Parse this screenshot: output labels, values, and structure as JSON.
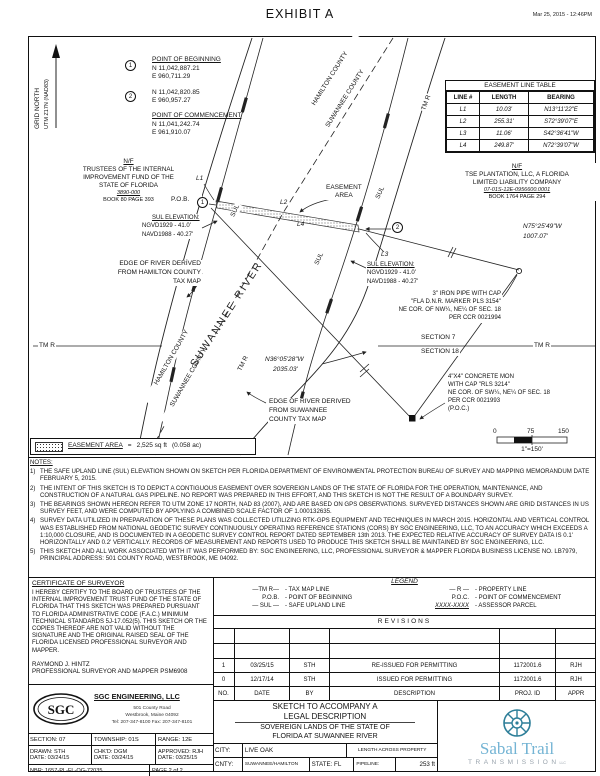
{
  "header": {
    "title": "EXHIBIT A",
    "timestamp": "Mar 25, 2015 - 12:46PM"
  },
  "north": {
    "line1": "GRID NORTH",
    "line2": "UTM Z17N (NAD83)"
  },
  "points": {
    "pob_num": "1",
    "pob_title": "POINT OF BEGINNING",
    "pob_n": "N 11,042,887.21",
    "pob_e": "E 960,711.29",
    "p2_num": "2",
    "p2_n": "N 11,042,820.85",
    "p2_e": "E 960,957.27",
    "poc_title": "POINT OF COMMENCEMENT",
    "poc_n": "N 11,041,242.74",
    "poc_e": "E 961,910.07"
  },
  "easement_table": {
    "title": "EASEMENT LINE TABLE",
    "headers": [
      "LINE #",
      "LENGTH",
      "BEARING"
    ],
    "rows": [
      [
        "L1",
        "10.03'",
        "N13°11'22\"E"
      ],
      [
        "L2",
        "255.31'",
        "S72°39'07\"E"
      ],
      [
        "L3",
        "11.06'",
        "S42°36'41\"W"
      ],
      [
        "L4",
        "249.87'",
        "N72°39'07\"W"
      ]
    ]
  },
  "owners": {
    "west": {
      "nf": "N/F",
      "name1": "TRUSTEES OF THE INTERNAL",
      "name2": "IMPROVEMENT FUND OF THE",
      "name3": "STATE OF FLORIDA",
      "parcel": "3890-000",
      "book": "BOOK 80 PAGE 393"
    },
    "east": {
      "nf": "N/F",
      "name1": "TSE PLANTATION, LLC, A FLORIDA",
      "name2": "LIMITED LIABILITY COMPANY",
      "parcel": "07-01S-12E-0956600.0001",
      "book": "BOOK 1764 PAGE 294"
    }
  },
  "map_labels": {
    "pob": "P.O.B.",
    "easement_area": "EASEMENT\nAREA",
    "l1": "L1",
    "l2": "L2",
    "l3": "L3",
    "l4": "L4",
    "sul": "SUL",
    "tm_r": "TM R",
    "hamilton": "HAMILTON COUNTY",
    "suwannee": "SUWANNEE COUNTY",
    "river": "SUWANNEE RIVER",
    "sul_elev_title": "SUL ELEVATION:",
    "sul_elev_ngvd": "NGVD1929 - 41.0'",
    "sul_elev_navd": "NAVD1988 - 40.27'",
    "bearing75_1": "N75°25'49\"W",
    "bearing75_2": "1007.07'",
    "bearing36_1": "N36°05'28\"W",
    "bearing36_2": "2035.03'",
    "iron1": "3\" IRON PIPE WITH CAP",
    "iron2": "\"FLA D.N.R. MARKER PLS 3154\"",
    "iron3": "NE COR. OF NW¼, NE¼ OF SEC. 18",
    "iron4": "PER CCR 0021994",
    "section7": "SECTION 7",
    "section18": "SECTION 18",
    "mon1": "4\"X4\" CONCRETE MON",
    "mon2": "WITH CAP \"RLS 3214\"",
    "mon3": "NE COR. OF SW¼, NE¼ OF SEC. 18",
    "mon4": "PER CCR 0021993",
    "mon5": "(P.O.C.)",
    "edge_hamilton1": "EDGE OF RIVER DERIVED",
    "edge_hamilton2": "FROM HAMILTON COUNTY",
    "edge_hamilton3": "TAX MAP",
    "edge_suwannee1": "EDGE OF RIVER DERIVED",
    "edge_suwannee2": "FROM SUWANNEE",
    "edge_suwannee3": "COUNTY TAX MAP"
  },
  "scale": {
    "t0": "0",
    "t75": "75",
    "t150": "150",
    "ratio": "1\"=150'"
  },
  "area_legend": {
    "label": "EASEMENT AREA",
    "eq": "=",
    "value": "2,525 sq ft",
    "ac": "(0.058 ac)"
  },
  "notes": {
    "title": "NOTES:",
    "items": [
      {
        "n": "1)",
        "t": "THE SAFE UPLAND LINE (SUL) ELEVATION SHOWN ON SKETCH PER FLORIDA DEPARTMENT OF ENVIRONMENTAL PROTECTION BUREAU OF SURVEY AND MAPPING MEMORANDUM DATE FEBRUARY 5, 2015."
      },
      {
        "n": "2)",
        "t": "THE INTENT OF THIS SKETCH IS TO DEPICT A CONTIGUOUS EASEMENT OVER SOVEREIGN LANDS OF THE STATE OF FLORIDA FOR THE OPERATION, MAINTENANCE, AND CONSTRUCTION OF A NATURAL GAS PIPELINE. NO REPORT WAS PREPARED IN THIS EFFORT, AND THIS SKETCH IS NOT THE RESULT OF A BOUNDARY SURVEY."
      },
      {
        "n": "3)",
        "t": "THE BEARINGS SHOWN HEREON REFER TO UTM ZONE 17 NORTH, NAD 83 (2007), AND ARE BASED ON GPS OBSERVATIONS. SURVEYED DISTANCES SHOWN ARE GRID DISTANCES IN US SURVEY FEET, AND WERE COMPUTED BY APPLYING A COMBINED SCALE FACTOR OF 1.000132635."
      },
      {
        "n": "4)",
        "t": "SURVEY DATA UTILIZED IN PREPARATION OF THESE PLANS WAS COLLECTED UTILIZING RTK-GPS EQUIPMENT AND TECHNIQUES IN MARCH 2015. HORIZONTAL AND VERTICAL CONTROL WAS ESTABLISHED FROM NATIONAL GEODETIC SURVEY CONTINUOUSLY OPERATING REFERENCE STATIONS (CORS) BY SGC ENGINEERING, LLC, TO AN ACCURACY WHICH EXCEEDS A 1:10,000 CLOSURE, AND IS DOCUMENTED IN A GEODETIC SURVEY CONTROL REPORT DATED SEPTEMBER 13th 2013. THE EXPECTED RELATIVE ACCURACY OF SURVEY DATA IS 0.1' HORIZONTALLY AND 0.2' VERTICALLY. RECORDS OF MEASUREMENT AND REPORTS USED TO PRODUCE THIS SKETCH SHALL BE MAINTAINED BY SGC ENGINEERING, LLC."
      },
      {
        "n": "5)",
        "t": "THIS SKETCH AND ALL WORK ASSOCIATED WITH IT WAS PERFORMED BY: SGC ENGINEERING, LLC, PROFESSIONAL SURVEYOR & MAPPER FLORIDA BUSINESS LICENSE NO. LB7979, PRINCIPAL ADDRESS: 501 COUNTY ROAD, WESTBROOK, ME 04092."
      }
    ]
  },
  "certificate": {
    "title": "CERTIFICATE OF SURVEYOR",
    "body": "I HEREBY CERTIFY TO THE BOARD OF TRUSTEES OF THE INTERNAL IMPROVEMENT TRUST FUND OF THE STATE OF FLORIDA THAT THIS SKETCH WAS PREPARED PURSUANT TO FLORIDA ADMINISTRATIVE CODE (F.A.C.) MINIMUM TECHNICAL STANDARDS 5J-17.052(5). THIS SKETCH OR THE COPIES THEREOF ARE NOT VALID WITHOUT THE SIGNATURE AND THE ORIGINAL RAISED SEAL OF THE FLORIDA LICENSED PROFESSIONAL SURVEYOR AND MAPPER.",
    "name": "RAYMOND J. HINTZ",
    "role": "PROFESSIONAL SURVEYOR AND MAPPER PSM6908"
  },
  "legend": {
    "title": "LEGEND",
    "items": [
      {
        "sym": "—TM R—",
        "desc": "- TAX MAP LINE"
      },
      {
        "sym": "— R —",
        "desc": "- PROPERTY LINE"
      },
      {
        "sym": "P.O.B.",
        "desc": "- POINT OF BEGINNING"
      },
      {
        "sym": "P.O.C.",
        "desc": "- POINT OF COMMENCEMENT"
      },
      {
        "sym": "— SUL —",
        "desc": "- SAFE UPLAND LINE"
      },
      {
        "sym": "XXXX-XXXX",
        "desc": "- ASSESSOR PARCEL"
      }
    ]
  },
  "revisions": {
    "title": "REVISIONS",
    "headers": [
      "NO.",
      "DATE",
      "BY",
      "DESCRIPTION",
      "PROJ. ID",
      "APPR"
    ],
    "rows": [
      [
        "1",
        "03/25/15",
        "STH",
        "RE-ISSUED FOR PERMITTING",
        "1172001.6",
        "RJH"
      ],
      [
        "0",
        "12/17/14",
        "STH",
        "ISSUED FOR PERMITTING",
        "1172001.6",
        "RJH"
      ]
    ]
  },
  "firm": {
    "logo": "SGC",
    "name": "SGC  ENGINEERING,  LLC",
    "addr1": "501 County Road",
    "addr2": "Westbrook, Maine 04092",
    "addr3": "Tel: 207-347-8100   Fax: 207-347-8101",
    "section_label": "SECTION:",
    "section": "07",
    "township_label": "TOWNSHIP:",
    "township": "01S",
    "range_label": "RANGE:",
    "range": "12E",
    "drawn_label": "DRAWN:",
    "drawn": "STH",
    "chkd_label": "CHK'D:",
    "chkd": "DGM",
    "approved_label": "APPROVED:",
    "approved": "RJH",
    "date_label": "DATE:",
    "date1": "03/24/15",
    "date2": "03/24/15",
    "date3": "03/25/15",
    "nbr_label": "NBR:",
    "nbr": "1657-PL-FL-OG-72035",
    "page": "PAGE  2  of  2"
  },
  "titleblock": {
    "line1": "SKETCH TO ACCOMPANY A",
    "line2": "LEGAL DESCRIPTION",
    "line3": "SOVEREIGN LANDS OF THE STATE OF",
    "line4": "FLORIDA AT SUWANNEE RIVER",
    "city_label": "CITY:",
    "city": "LIVE OAK",
    "cnty_label": "CNTY:",
    "cnty": "SUWANNEE/HAMILTON",
    "state_label": "STATE:",
    "state": "FL",
    "lap_label": "LENGTH ACROSS PROPERTY",
    "pipeline_label": "PIPELINE:",
    "pipeline": "253 ft"
  },
  "brand": {
    "name": "Sabal Trail",
    "sub": "TRANSMISSION",
    "llc": "LLC",
    "blue": "#74b4d4",
    "gray": "#9aa4ad",
    "teal": "#2e7f99"
  }
}
